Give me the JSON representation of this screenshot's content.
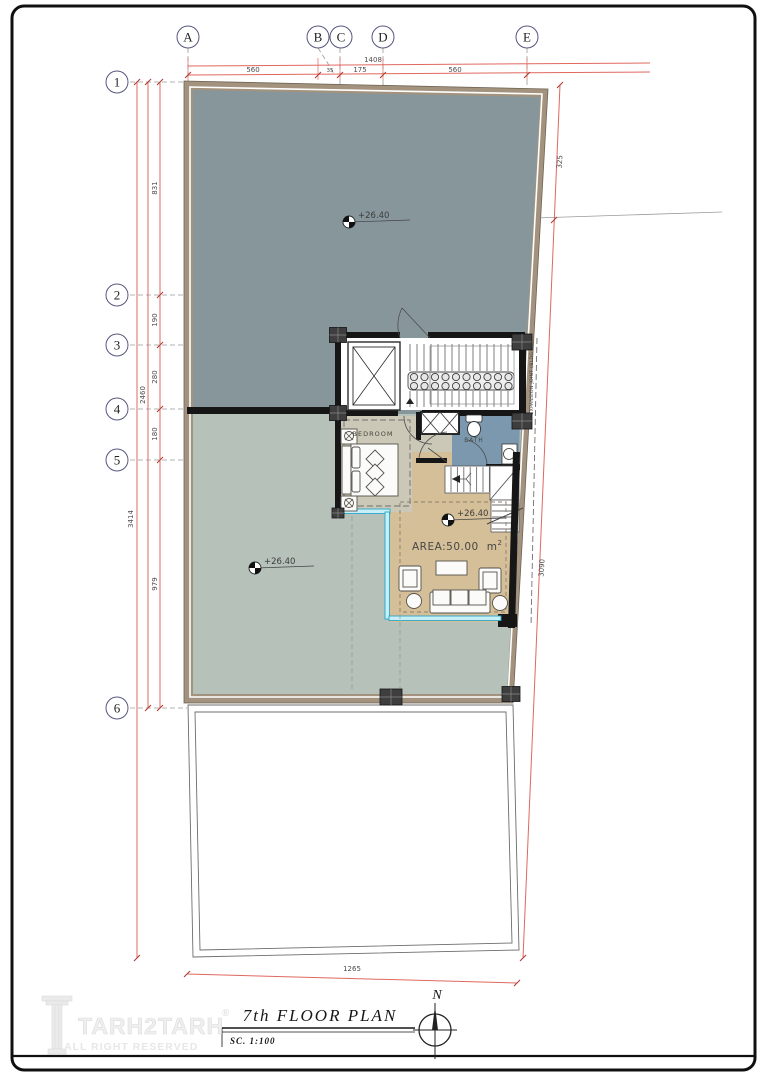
{
  "sheet": {
    "title": "7th  FLOOR  PLAN",
    "scale": "SC.  1:100",
    "north": "N"
  },
  "logo": {
    "name": "TARH2TARH",
    "registered": "®",
    "tagline": "ALL RIGHT RESERVED"
  },
  "grid": {
    "cols": [
      "A",
      "B",
      "C",
      "D",
      "E"
    ],
    "rows": [
      "1",
      "2",
      "3",
      "4",
      "5",
      "6"
    ]
  },
  "dims": {
    "top_total": "1408",
    "top_segments": [
      "560",
      "35",
      "175",
      "560"
    ],
    "left_total_outer": "3414",
    "left_total": "2460",
    "left_segments": [
      "831",
      "190",
      "280",
      "180",
      "979"
    ],
    "right_upper": "325",
    "right_lower": "3090",
    "bottom": "1265"
  },
  "labels": {
    "bedroom": "BEDROOM",
    "bath": "BATH",
    "area": "AREA:50.00",
    "area_unit": "m",
    "area_sup": "2",
    "level": "+26.40",
    "expansion": "EXPANSION JOINT (BLDG 20)"
  },
  "colors": {
    "dim_red": "#e0685f",
    "roof_gray": "#87969b",
    "terrace_gray": "#b6c1ba",
    "unit_tan": "#d5bf99",
    "bath_blue": "#7b98ae",
    "room_beige": "#cbc8b7",
    "wall_tan": "#a3937e",
    "window_cyan": "#2aa7c8",
    "wall_black": "#161616"
  }
}
